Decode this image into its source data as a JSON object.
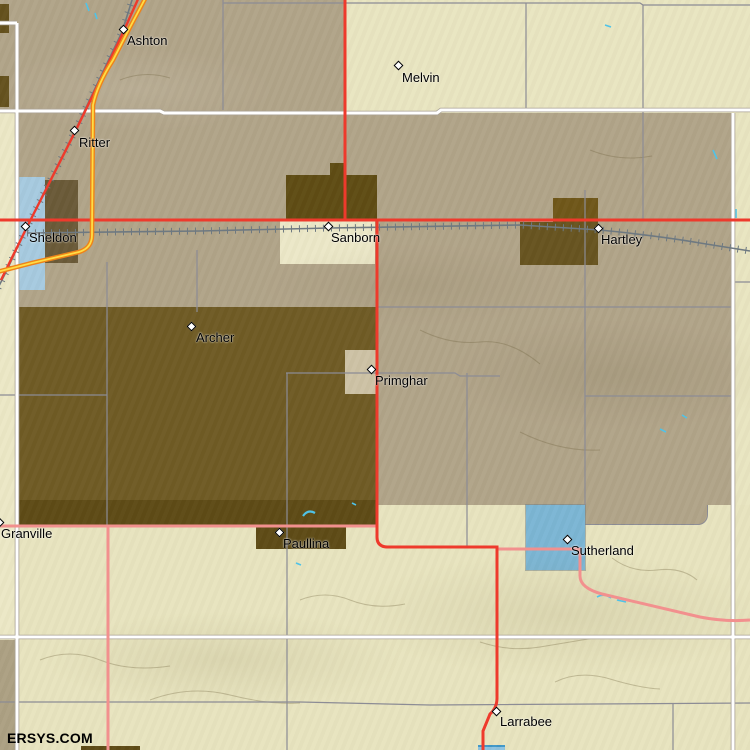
{
  "map": {
    "watermark": "ERSYS.COM",
    "towns": [
      {
        "name": "Ashton",
        "x": 124,
        "y": 30
      },
      {
        "name": "Melvin",
        "x": 399,
        "y": 66
      },
      {
        "name": "Ritter",
        "x": 75,
        "y": 131
      },
      {
        "name": "Sheldon",
        "x": 26,
        "y": 227
      },
      {
        "name": "Sanborn",
        "x": 329,
        "y": 227
      },
      {
        "name": "Hartley",
        "x": 599,
        "y": 229
      },
      {
        "name": "Archer",
        "x": 192,
        "y": 327
      },
      {
        "name": "Primghar",
        "x": 372,
        "y": 370
      },
      {
        "name": "Granville",
        "x": 0,
        "y": 523
      },
      {
        "name": "Paullina",
        "x": 280,
        "y": 533
      },
      {
        "name": "Sutherland",
        "x": 568,
        "y": 540
      },
      {
        "name": "Larrabee",
        "x": 497,
        "y": 712
      }
    ],
    "palette": {
      "terrain_tan": "#b1a489",
      "terrain_cream": "#e9e5c1",
      "urban_brown": "#6f5b25",
      "urban_brown_dark": "#5e4b16",
      "urban_brown_gray": "#6a5a38",
      "water_light_blue": "#a6cadf",
      "water_steel_blue": "#7cb6d4",
      "road_red": "#ee3a2c",
      "road_pink": "#f2908e",
      "road_white": "#ffffff",
      "road_gray": "#8c8c95",
      "highway_orange": "#ef8318",
      "highway_yellow": "#ffdd45",
      "railroad_gray": "#6e7981",
      "stream_cyan": "#4fc3e8",
      "label_color": "#000000"
    }
  }
}
